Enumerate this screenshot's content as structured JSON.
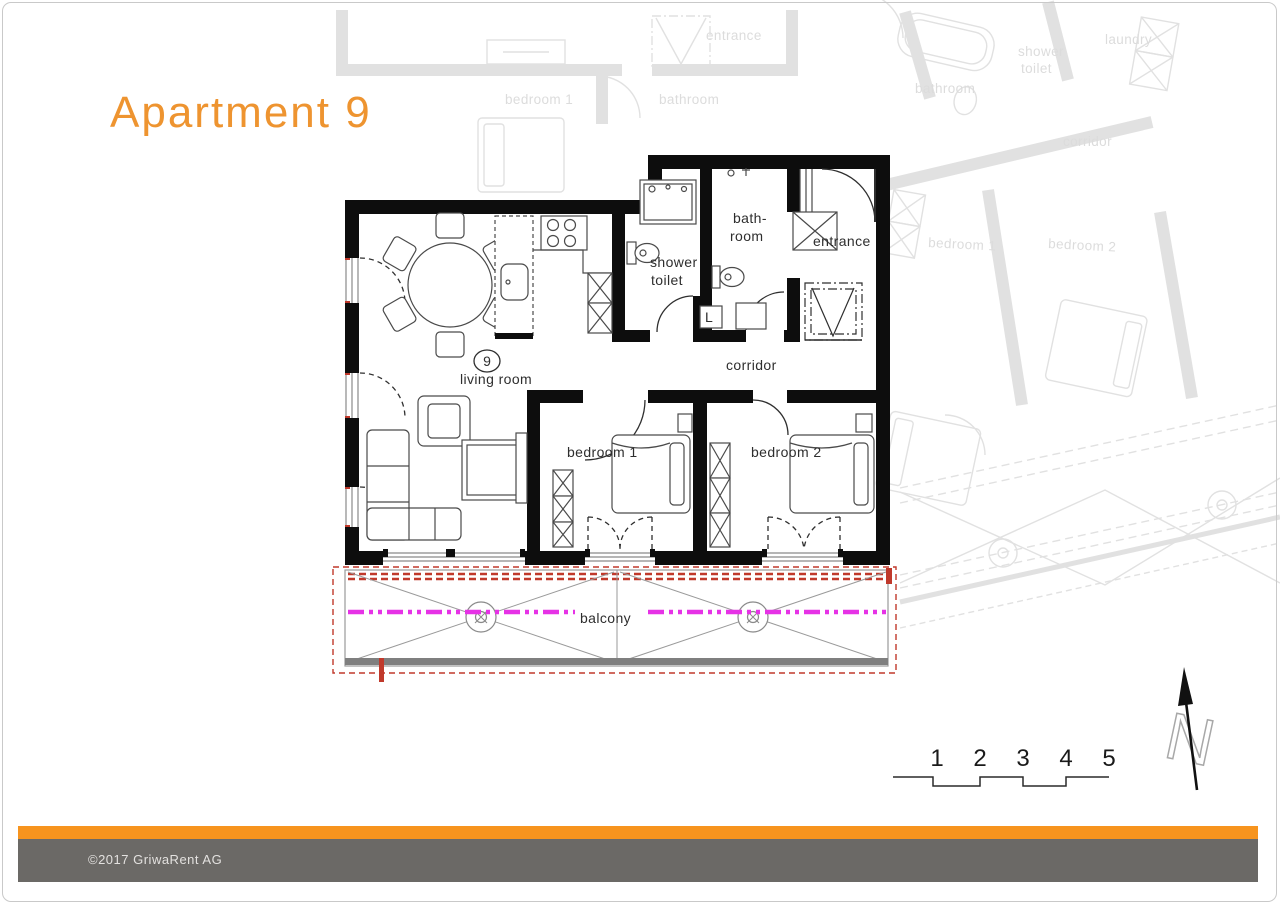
{
  "page": {
    "title": "Apartment 9",
    "footer": {
      "copyright": "©2017 GriwaRent AG"
    }
  },
  "plan": {
    "unit_number": "9",
    "rooms": {
      "living_room": "living room",
      "bedroom1": "bedroom 1",
      "bedroom2": "bedroom 2",
      "shower_line1": "shower",
      "shower_line2": "toilet",
      "bath_line1": "bath-",
      "bath_line2": "room",
      "entrance": "entrance",
      "corridor": "corridor",
      "balcony": "balcony",
      "laundry_abbr": "L"
    },
    "colors": {
      "accent_orange": "#ee9430",
      "footer_bar_orange": "#f7941e",
      "footer_band_gray": "#6b6966",
      "wall_black": "#0d0d0d",
      "faded_gray": "#e1e1e1",
      "balcony_red": "#c0392b",
      "axis_magenta": "#e632e6"
    }
  },
  "background_labels": {
    "top_bedroom1": "bedroom 1",
    "top_bathroom": "bathroom",
    "top_entrance": "entrance",
    "right_bathroom": "bathroom",
    "right_shower1": "shower",
    "right_shower2": "toilet",
    "right_laundry": "laundry",
    "right_corridor": "corridor",
    "right_bedroom1": "bedroom 1",
    "right_bedroom2": "bedroom 2"
  },
  "scale_bar": {
    "labels": [
      "1",
      "2",
      "3",
      "4",
      "5"
    ]
  },
  "compass": {
    "letter": "N"
  }
}
